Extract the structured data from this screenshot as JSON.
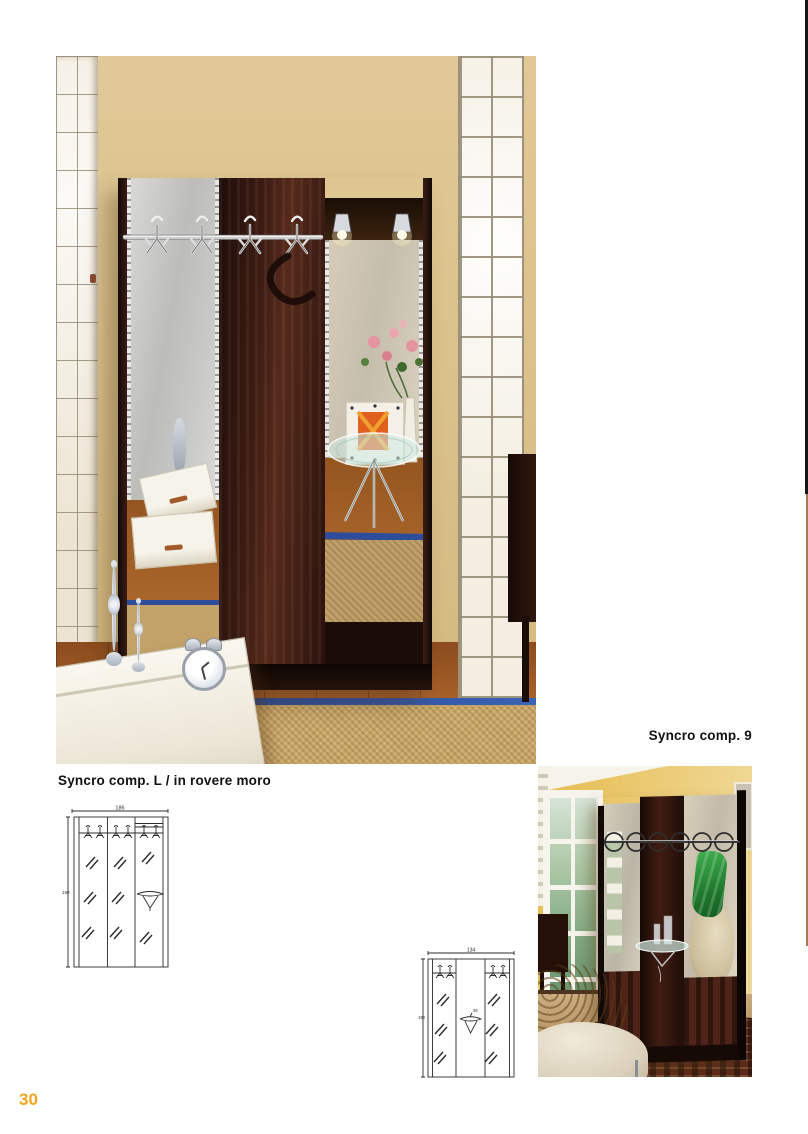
{
  "page": {
    "number": "30"
  },
  "captions": {
    "comp9": "Syncro comp. 9",
    "compL": "Syncro comp. L / in rovere moro"
  },
  "drawings": {
    "compL": {
      "width_label": "186",
      "height_label": "190"
    },
    "comp9": {
      "width_label": "134",
      "height_label": "190",
      "shelf_label": "35"
    }
  },
  "colors": {
    "page_number_accent": "#f2a51d",
    "caption_text": "#111111",
    "wall_beige": "#dac089",
    "wall_yellow": "#e6bc4f",
    "unit_wood_dark": "#2a120c",
    "mirror_gray": "#c9c9c7",
    "rug_border_blue": "#2d4d9c",
    "floor_wood": "#a6602a",
    "rug_sisal": "#c8a567",
    "garment_green": "#1f7a2e",
    "drawing_stroke": "#2b2b2b",
    "edge_strip_black": "#161616",
    "edge_strip_brown": "#a87952"
  }
}
